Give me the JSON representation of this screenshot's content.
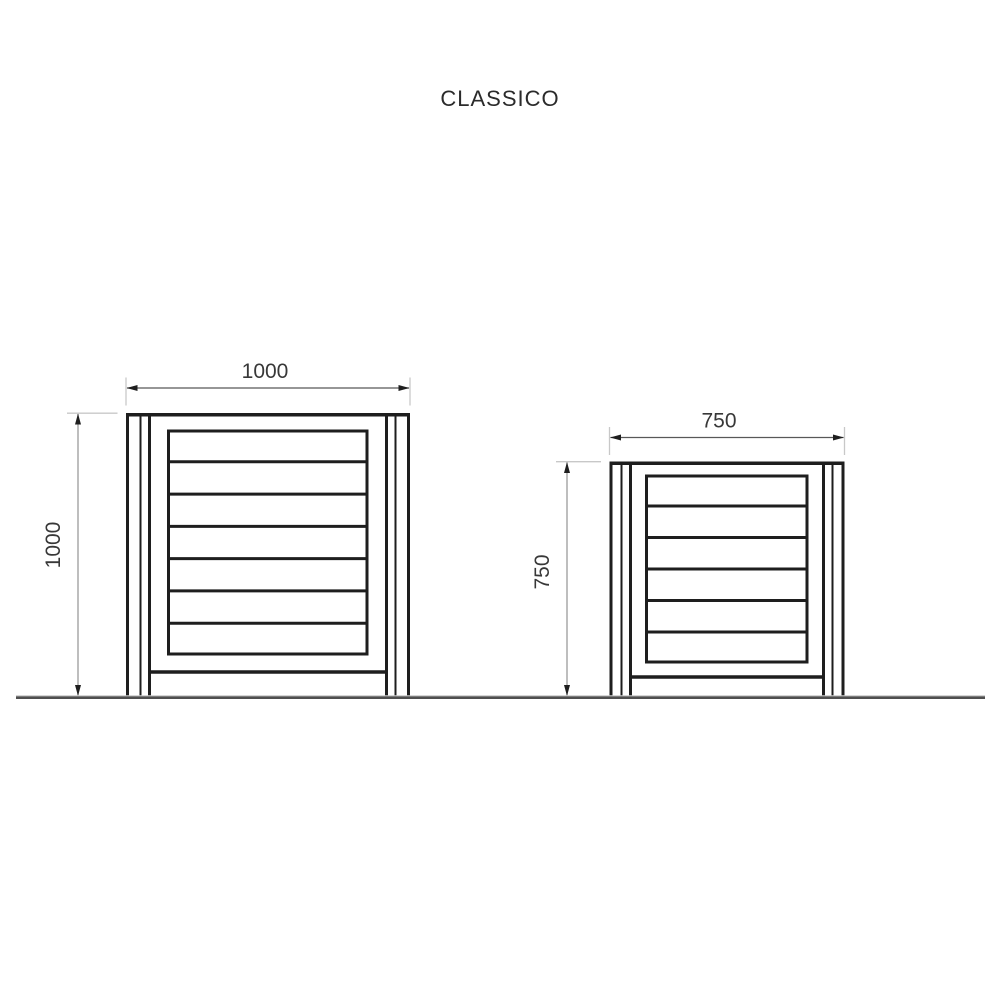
{
  "title": "CLASSICO",
  "colors": {
    "line": "#1e1e1e",
    "dim_line_horizontal": "#585858",
    "dim_line_vertical": "#9b9b9b",
    "extension_line": "#c8c8c8",
    "arrow": "#1f1f1f",
    "dim_text": "#383838",
    "ground_dark": "#4f4f4f",
    "ground_light": "#c9c9c9",
    "background": "#ffffff"
  },
  "drawing": {
    "ground": {
      "x1": 16,
      "x2": 985,
      "y_light": 695.9,
      "y_dark": 697.7
    },
    "panels": [
      {
        "id": "classico-1000",
        "width_label": "1000",
        "height_label": "1000",
        "outer_left": 126,
        "outer_right": 410,
        "top": 413,
        "bottom": 696.5,
        "post_width": 25,
        "post_mid_inset": 10.5,
        "slat_box": {
          "left": 167,
          "right": 368.5,
          "top": 429.5,
          "bottom": 655.5
        },
        "slat_count": 7,
        "bottom_rail_y": 672,
        "width_dim": {
          "line_y": 388,
          "text_x": 265,
          "text_y": 378
        },
        "height_dim": {
          "line_x": 78,
          "text_x": 60,
          "text_y": 545
        }
      },
      {
        "id": "classico-750",
        "width_label": "750",
        "height_label": "750",
        "outer_left": 609.5,
        "outer_right": 844.5,
        "top": 461.5,
        "bottom": 696.5,
        "post_width": 22.5,
        "post_mid_inset": 10.5,
        "slat_box": {
          "left": 645,
          "right": 808.5,
          "top": 474.5,
          "bottom": 663.5
        },
        "slat_count": 6,
        "bottom_rail_y": 677,
        "width_dim": {
          "line_y": 437.5,
          "text_x": 719,
          "text_y": 427.5
        },
        "height_dim": {
          "line_x": 567,
          "text_x": 549,
          "text_y": 572
        }
      }
    ]
  }
}
